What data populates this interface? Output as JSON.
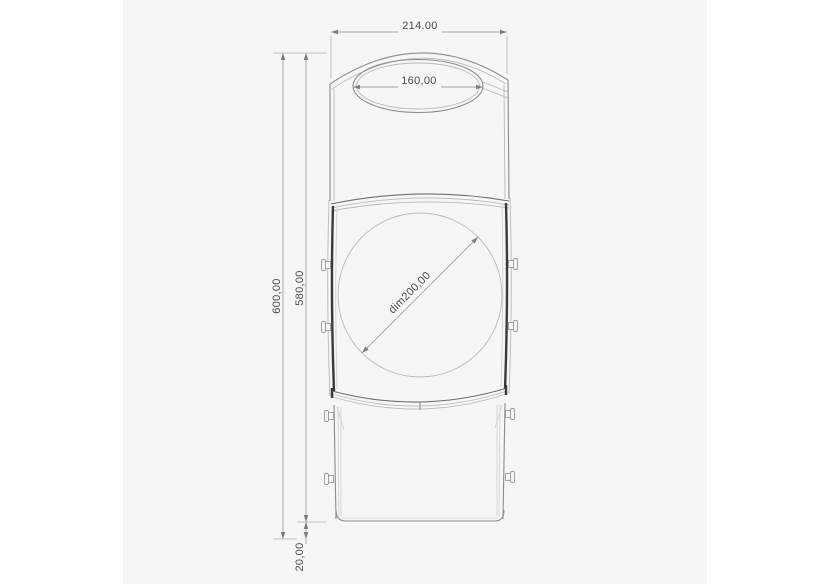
{
  "page": {
    "background_color": "#ffffff",
    "canvas_color": "#f6f6f6"
  },
  "drawing": {
    "kind": "technical-drawing-front-view",
    "colors": {
      "dimension_line": "#a3a3a3",
      "dimension_text": "#4b4b4b",
      "outline_light": "#b9b9b9",
      "outline_medium": "#8c8c8c",
      "outline_dark": "#3a3a3a"
    },
    "dimensions": {
      "top_width": "214.00",
      "opening_width": "160,00",
      "overall_height": "600,00",
      "upper_height": "580,00",
      "circle_diameter": "dim200,00",
      "base_height": "20,00"
    }
  }
}
